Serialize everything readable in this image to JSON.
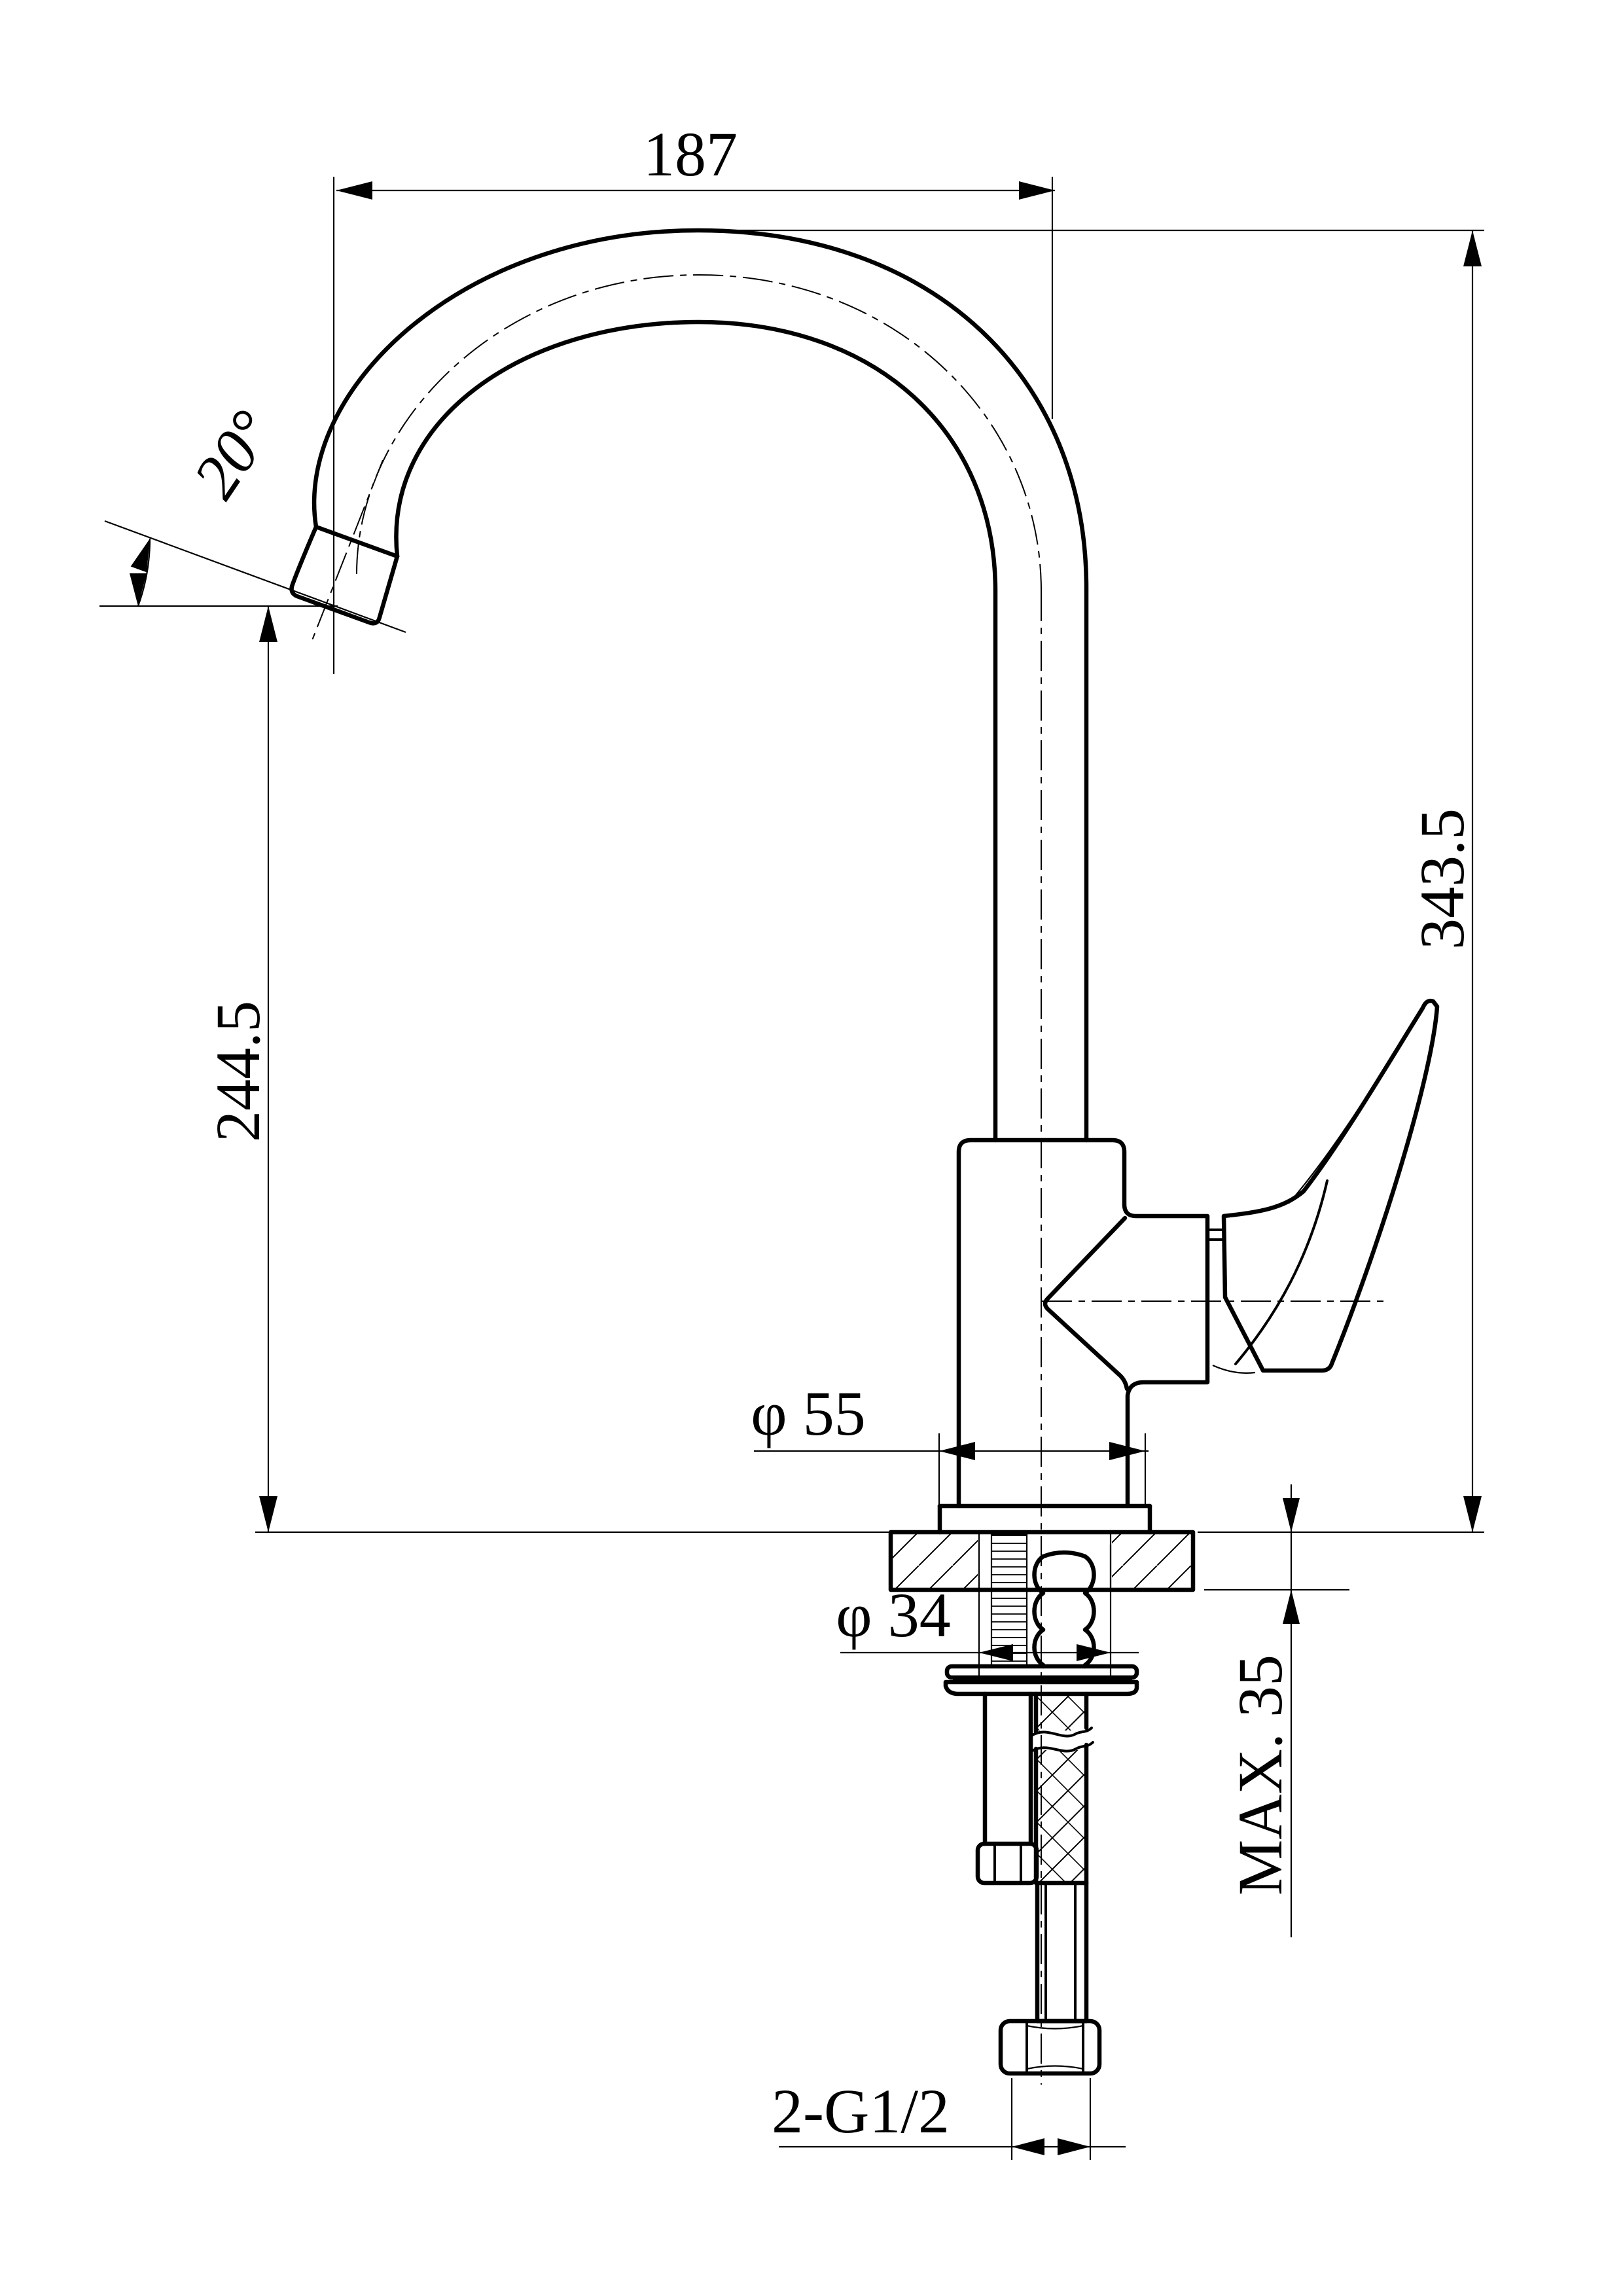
{
  "drawing": {
    "type": "technical-drawing",
    "subject": "single-handle kitchen faucet with gooseneck spout, side section view",
    "line_color": "#000000",
    "background_color": "#ffffff"
  },
  "dimensions": {
    "spout_reach": "187",
    "spout_angle": "20°",
    "spout_outlet_height": "244.5",
    "total_height": "343.5",
    "body_diameter": "φ 55",
    "hole_diameter": "φ 34",
    "max_deck_thickness": "MAX. 35",
    "thread_spec": "2-G1/2"
  }
}
